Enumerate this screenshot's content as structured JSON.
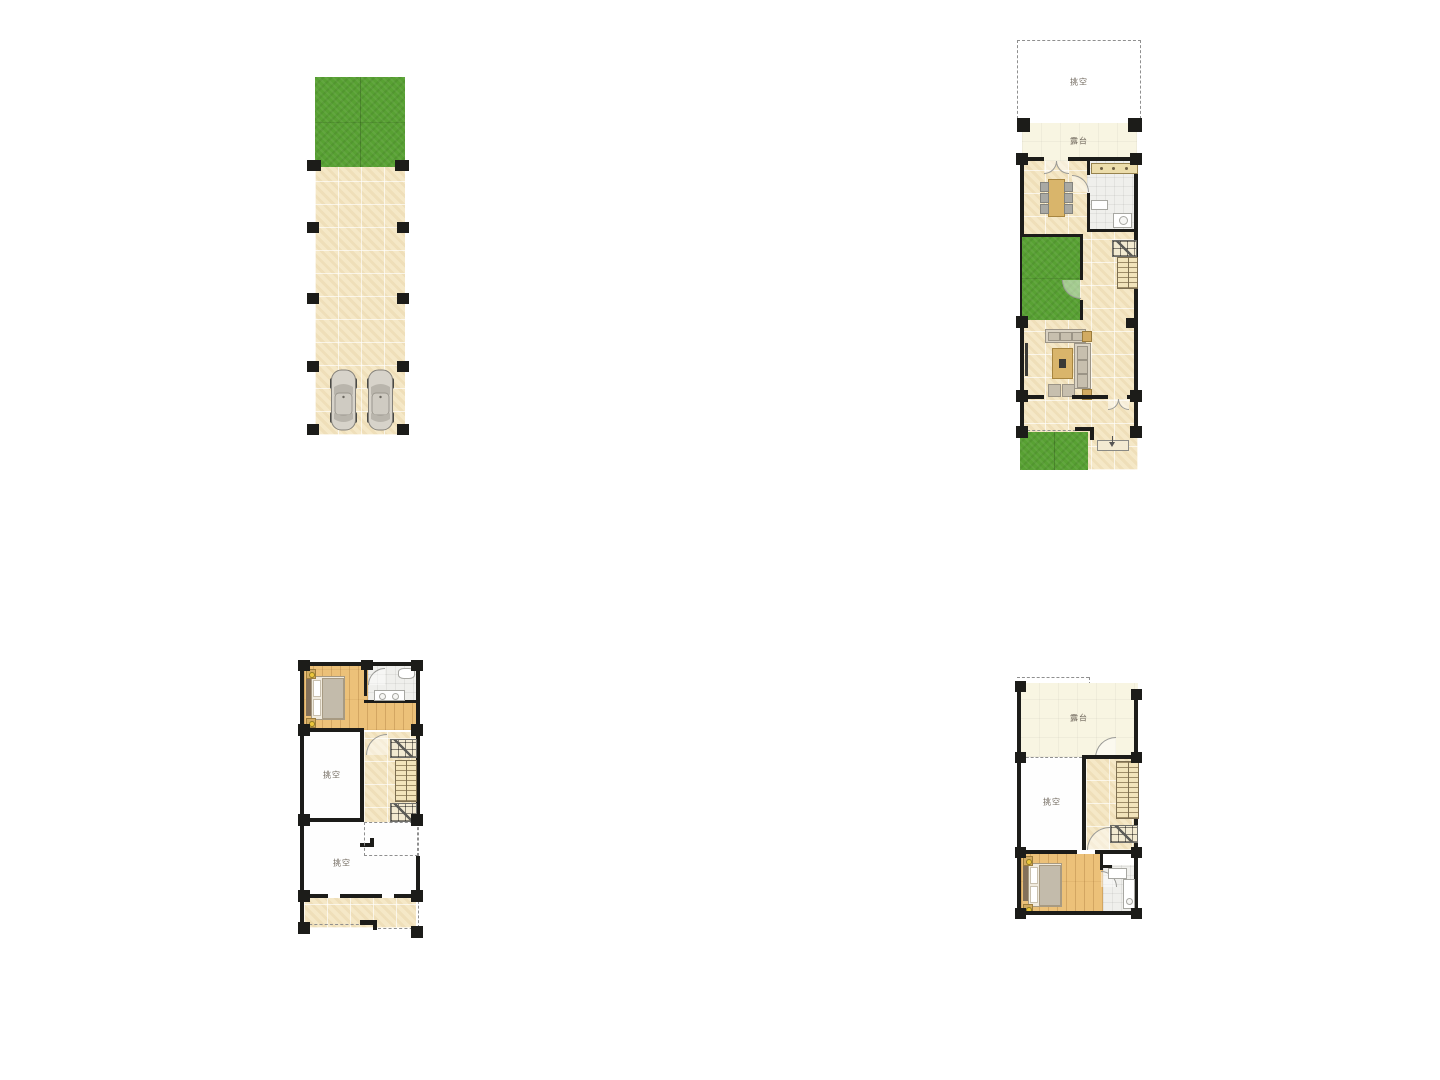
{
  "labels": {
    "void": "挑空",
    "terrace": "露台"
  },
  "colors": {
    "lawn": "#58a133",
    "paving": "#f5e8c7",
    "wood_floor": "#ecc179",
    "terrace_cream": "#f8f5e2",
    "bath_tile": "#efefec",
    "wall": "#1c1c19",
    "background": "#ffffff",
    "dashed_line": "#8f8f8f",
    "label_text": "#6d655a"
  },
  "plans": {
    "garage_courtyard": {
      "cars": 2,
      "lawn_panels": 2
    },
    "ground_floor": {
      "void_label": "挑空",
      "terrace_label": "露台"
    },
    "second_floor": {
      "void_labels": [
        "挑空",
        "挑空"
      ]
    },
    "third_floor": {
      "void_label": "挑空",
      "terrace_label": "露台"
    }
  }
}
